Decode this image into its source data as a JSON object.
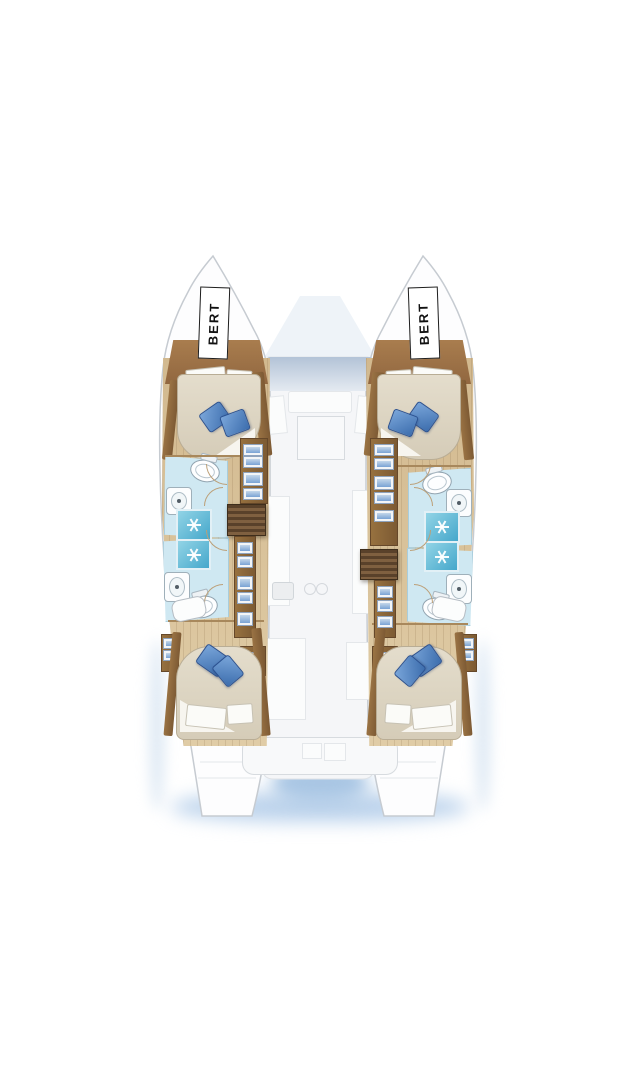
{
  "page": {
    "background_color": "#ffffff",
    "description": "Catamaran yacht interior layout floor plan, top-down ghosted view"
  },
  "labels": {
    "left_bow": "BERT",
    "right_bow": "BERT"
  },
  "colors": {
    "hull_fill": "#fdfdfe",
    "hull_outline": "#c6cbd1",
    "wood_floor": "#d8c29c",
    "wood_trim": "#a1764a",
    "wood_dark": "#7c5a33",
    "mattress_cream": "#ded6c5",
    "pillow_blue": "#4d82c2",
    "bathroom_floor_blue": "#cfe8f2",
    "shower_tile_cyan": "#55b4d4",
    "stairs_dark_brown": "#59412a",
    "drawer_accent_blue": "#7aa3d4",
    "ghost_grey": "#e3e5e8",
    "window_glass_blue": "#b7c7da",
    "water_shadow_blue": "#bcd3ec"
  },
  "hulls": [
    {
      "side": "left",
      "bow_label": "BERT",
      "rooms": [
        "forward-cabin",
        "forward-bathroom",
        "aft-bathroom",
        "aft-cabin"
      ],
      "fixtures": [
        "double-berth",
        "blue-pillows",
        "toilet",
        "washbasin",
        "shower",
        "storage-drawers",
        "companionway-stairs",
        "vanity-table"
      ]
    },
    {
      "side": "right",
      "bow_label": "BERT",
      "rooms": [
        "forward-cabin",
        "forward-bathroom",
        "aft-bathroom",
        "aft-cabin"
      ],
      "fixtures": [
        "double-berth",
        "blue-pillows",
        "toilet",
        "washbasin",
        "shower",
        "storage-drawers",
        "companionway-stairs",
        "vanity-table"
      ]
    }
  ],
  "center_section": {
    "areas": [
      "foredeck",
      "saloon-window",
      "saloon-seating",
      "galley",
      "cockpit",
      "aft-bench",
      "swim-platforms"
    ]
  }
}
